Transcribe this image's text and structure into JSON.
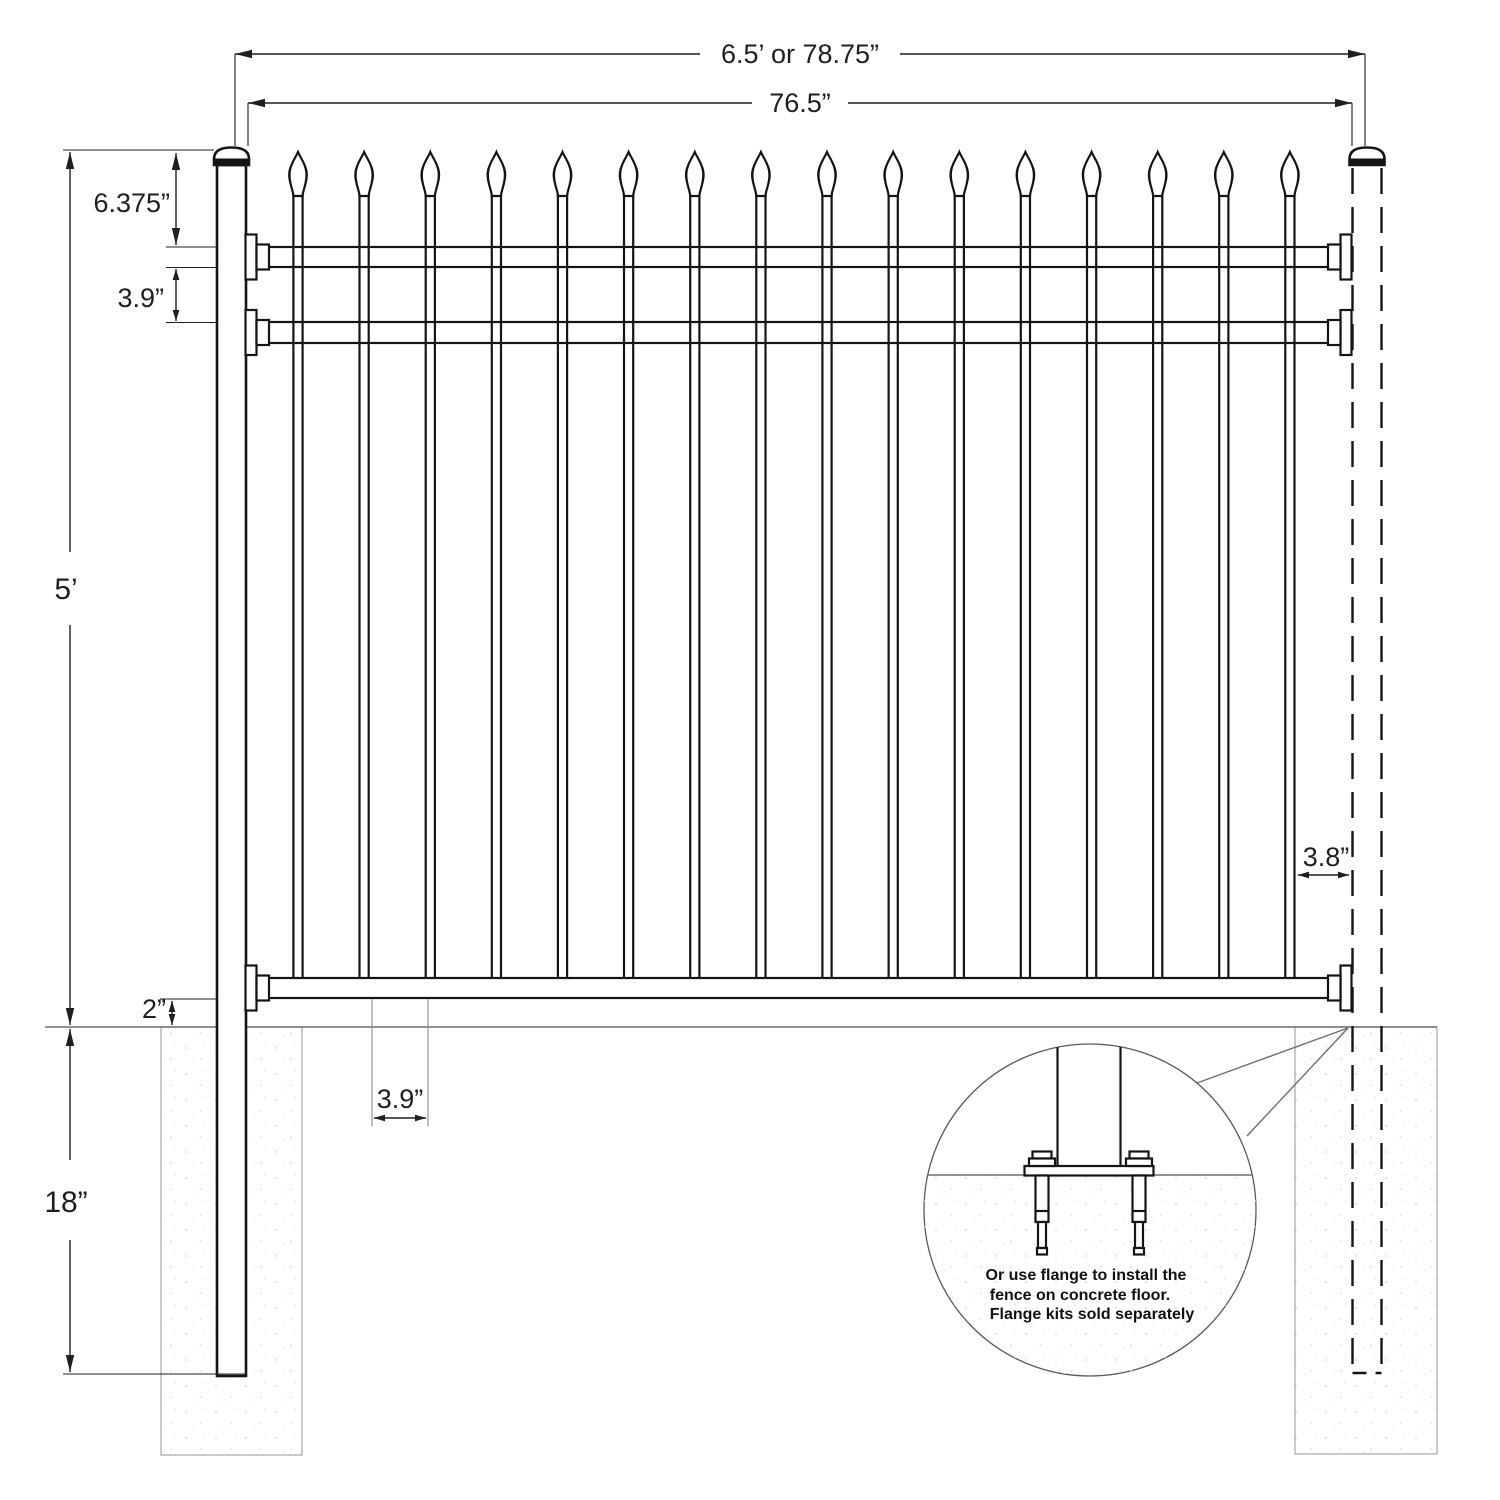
{
  "diagram": {
    "type": "fence-panel-installation-drawing",
    "dims": {
      "total_width": "6.5’ or 78.75”",
      "panel_width": "76.5”",
      "top_offset": "6.375”",
      "rail_spacing": "3.9”",
      "fence_height": "5’",
      "ground_clearance": "2”",
      "underground_depth": "18”",
      "picket_gap": "3.9”",
      "end_gap": "3.8”"
    },
    "note_lines": [
      "Or use flange to install the",
      "fence on concrete floor.",
      "Flange kits sold separately"
    ],
    "fence": {
      "picket_count": 16,
      "rail_count": 3,
      "post_count": 2
    },
    "colors": {
      "line": "#141414",
      "dim": "#1f1f1f",
      "soft": "#6e6e6e",
      "faint": "#a6a6a6"
    }
  }
}
